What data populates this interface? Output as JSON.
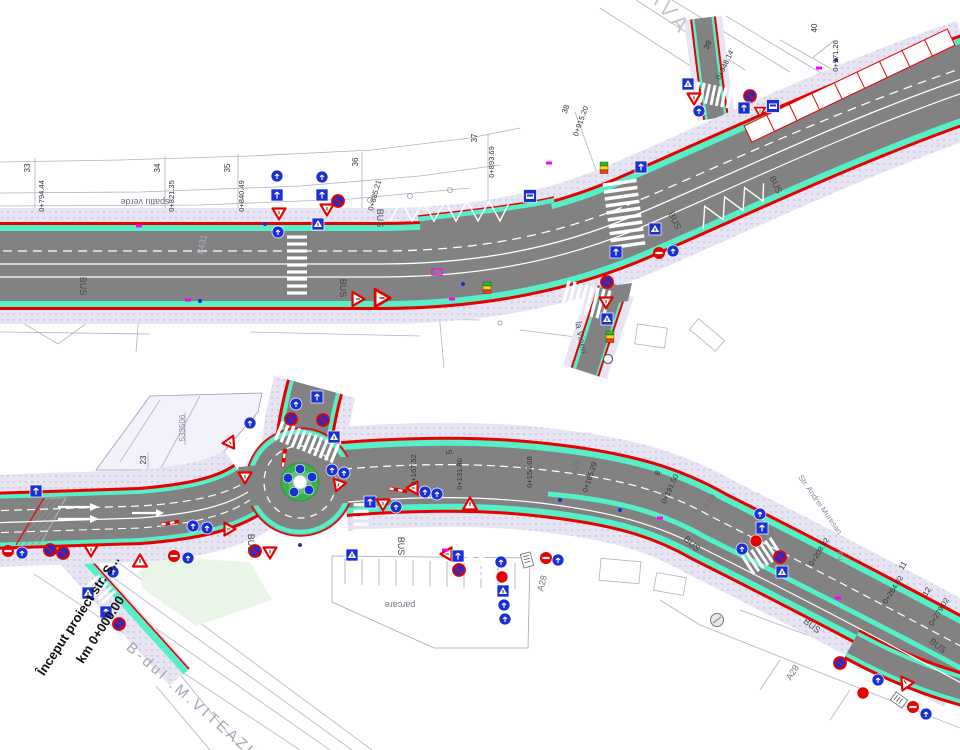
{
  "colors": {
    "asphalt": "#828282",
    "bike_lane_cyan": "#55f0c8",
    "sidewalk_lavender": "#e7e4f3",
    "edge_red": "#e60000",
    "sign_blue": "#1a2fd4",
    "sign_red": "#e60000",
    "marking_white": "#ffffff",
    "magenta_marker": "#ff00ff",
    "signal_green": "#22c31e",
    "signal_yellow": "#ffd800",
    "signal_red": "#ff3c00",
    "island_green": "#38b24d",
    "cadastral_grey": "#b4b0c6"
  },
  "top_plan": {
    "labels": [
      {
        "t": "33",
        "x": 30,
        "y": 168,
        "r": -90,
        "s": 8
      },
      {
        "t": "0+794.44",
        "x": 44,
        "y": 196,
        "r": -90,
        "s": 7.5
      },
      {
        "t": "34",
        "x": 160,
        "y": 168,
        "r": -90,
        "s": 8
      },
      {
        "t": "0+821.35",
        "x": 174,
        "y": 196,
        "r": -90,
        "s": 7.5
      },
      {
        "t": "35",
        "x": 230,
        "y": 168,
        "r": -90,
        "s": 8
      },
      {
        "t": "0+840.49",
        "x": 244,
        "y": 196,
        "r": -90,
        "s": 7.5
      },
      {
        "t": "36",
        "x": 358,
        "y": 162,
        "r": -90,
        "s": 8
      },
      {
        "t": "0+885.21",
        "x": 377,
        "y": 196,
        "r": -75,
        "s": 7.5
      },
      {
        "t": "37",
        "x": 477,
        "y": 138,
        "r": -90,
        "s": 8
      },
      {
        "t": "0+893.69",
        "x": 494,
        "y": 162,
        "r": -90,
        "s": 7.5
      },
      {
        "t": "38",
        "x": 568,
        "y": 110,
        "r": -70,
        "s": 8
      },
      {
        "t": "0+915.20",
        "x": 583,
        "y": 122,
        "r": -70,
        "s": 7.5
      },
      {
        "t": "39",
        "x": 710,
        "y": 46,
        "r": -65,
        "s": 8
      },
      {
        "t": "0+948.14",
        "x": 727,
        "y": 66,
        "r": -65,
        "s": 7.5
      },
      {
        "t": "40",
        "x": 817,
        "y": 28,
        "r": -90,
        "s": 8
      },
      {
        "t": "0+971.26",
        "x": 838,
        "y": 56,
        "r": -90,
        "s": 7.5
      },
      {
        "t": "spatiu verde",
        "x": 145,
        "y": 199,
        "r": 180,
        "s": 9,
        "c": "#6f6c80"
      },
      {
        "t": "AVA",
        "x": 664,
        "y": 16,
        "r": 50,
        "s": 22,
        "c": "#c6c6cc",
        "serif": true,
        "ls": 5
      },
      {
        "t": "8431",
        "x": 205,
        "y": 245,
        "r": -78,
        "s": 9,
        "c": "#b3adc6"
      },
      {
        "t": "la Vineri",
        "x": 578,
        "y": 338,
        "r": 80,
        "s": 9,
        "c": "#55525f"
      },
      {
        "t": "BUS",
        "x": 80,
        "y": 286,
        "r": 90,
        "s": 9,
        "c": "#464646"
      },
      {
        "t": "BUS",
        "x": 340,
        "y": 288,
        "r": 90,
        "s": 9,
        "c": "#464646"
      },
      {
        "t": "BUS",
        "x": 377,
        "y": 218,
        "r": 90,
        "s": 9,
        "c": "#464646"
      },
      {
        "t": "BUS",
        "x": 672,
        "y": 222,
        "r": 64,
        "s": 9,
        "c": "#464646"
      },
      {
        "t": "BUS",
        "x": 773,
        "y": 186,
        "r": 64,
        "s": 9,
        "c": "#464646"
      }
    ],
    "signs": [
      {
        "t": "blue",
        "x": 277,
        "y": 176
      },
      {
        "t": "sq",
        "x": 277,
        "y": 195
      },
      {
        "t": "yield",
        "x": 279,
        "y": 214
      },
      {
        "t": "blue",
        "x": 278,
        "y": 232
      },
      {
        "t": "blue",
        "x": 322,
        "y": 177
      },
      {
        "t": "sq",
        "x": 322,
        "y": 195
      },
      {
        "t": "yield",
        "x": 327,
        "y": 210
      },
      {
        "t": "sqA",
        "x": 318,
        "y": 224
      },
      {
        "t": "nostop",
        "x": 338,
        "y": 201
      },
      {
        "t": "warn",
        "x": 358,
        "y": 299,
        "r": 90
      },
      {
        "t": "warn",
        "x": 382,
        "y": 298,
        "r": 90,
        "sc": 1.25
      },
      {
        "t": "bus",
        "x": 530,
        "y": 196
      },
      {
        "t": "sq",
        "x": 641,
        "y": 167
      },
      {
        "t": "signal",
        "x": 604,
        "y": 168
      },
      {
        "t": "sqA",
        "x": 655,
        "y": 229
      },
      {
        "t": "sq",
        "x": 616,
        "y": 252
      },
      {
        "t": "noentry",
        "x": 659,
        "y": 253
      },
      {
        "t": "blue",
        "x": 673,
        "y": 251
      },
      {
        "t": "nostop",
        "x": 607,
        "y": 282
      },
      {
        "t": "yield",
        "x": 606,
        "y": 303
      },
      {
        "t": "sqA",
        "x": 607,
        "y": 319
      },
      {
        "t": "signal",
        "x": 610,
        "y": 337
      },
      {
        "t": "pole",
        "x": 608,
        "y": 359
      },
      {
        "t": "sqA",
        "x": 688,
        "y": 84
      },
      {
        "t": "yield",
        "x": 694,
        "y": 99
      },
      {
        "t": "blue",
        "x": 699,
        "y": 111
      },
      {
        "t": "nostop",
        "x": 750,
        "y": 96
      },
      {
        "t": "sq",
        "x": 744,
        "y": 108
      },
      {
        "t": "yield",
        "x": 760,
        "y": 112,
        "sc": 0.8
      },
      {
        "t": "bus",
        "x": 773,
        "y": 106
      },
      {
        "t": "signal",
        "x": 487,
        "y": 288
      },
      {
        "t": "dot",
        "x": 265,
        "y": 224
      },
      {
        "t": "dot",
        "x": 200,
        "y": 301
      },
      {
        "t": "dot",
        "x": 463,
        "y": 284
      },
      {
        "t": "dot",
        "x": 836,
        "y": 60
      },
      {
        "t": "mag",
        "x": 139,
        "y": 226
      },
      {
        "t": "mag",
        "x": 188,
        "y": 300
      },
      {
        "t": "mag",
        "x": 549,
        "y": 163
      },
      {
        "t": "mag",
        "x": 819,
        "y": 68
      },
      {
        "t": "magr",
        "x": 437,
        "y": 272
      },
      {
        "t": "mag",
        "x": 452,
        "y": 299
      }
    ]
  },
  "bottom_plan": {
    "labels": [
      {
        "t": "Început proiect str. S...",
        "x": 82,
        "y": 618,
        "r": -57,
        "s": 13,
        "c": "#111111",
        "b": true,
        "serif": true
      },
      {
        "t": "km 0+000.00",
        "x": 104,
        "y": 632,
        "r": -57,
        "s": 13,
        "c": "#111111",
        "b": true,
        "serif": true
      },
      {
        "t": "B-dul .M.VITEAZU",
        "x": 190,
        "y": 705,
        "r": 41,
        "s": 15,
        "c": "#a8a5b5",
        "serif": true,
        "ls": 3
      },
      {
        "t": "parcare",
        "x": 400,
        "y": 602,
        "r": 180,
        "s": 9,
        "c": "#777487"
      },
      {
        "t": "533506",
        "x": 185,
        "y": 428,
        "r": -90,
        "s": 8,
        "c": "#8b88a0"
      },
      {
        "t": "23",
        "x": 146,
        "y": 460,
        "r": -90,
        "s": 8
      },
      {
        "t": "5",
        "x": 452,
        "y": 452,
        "r": -90,
        "s": 8
      },
      {
        "t": "0+131.80",
        "x": 462,
        "y": 474,
        "r": -90,
        "s": 7.5
      },
      {
        "t": "0+154.08",
        "x": 532,
        "y": 472,
        "r": -90,
        "s": 7.5
      },
      {
        "t": "A26",
        "x": 578,
        "y": 468,
        "r": -72,
        "s": 9,
        "c": "#77747f"
      },
      {
        "t": "0+165.29",
        "x": 592,
        "y": 478,
        "r": -72,
        "s": 7.5
      },
      {
        "t": "8",
        "x": 660,
        "y": 474,
        "r": -65,
        "s": 8
      },
      {
        "t": "0+191.50",
        "x": 672,
        "y": 490,
        "r": -65,
        "s": 7.5
      },
      {
        "t": "A29",
        "x": 712,
        "y": 503,
        "r": -58,
        "s": 9,
        "c": "#77747f"
      },
      {
        "t": "Str. Andrei Muresan",
        "x": 818,
        "y": 506,
        "r": 55,
        "s": 8,
        "c": "#8b88a0"
      },
      {
        "t": "0+167.52",
        "x": 416,
        "y": 470,
        "r": -90,
        "s": 7.5
      },
      {
        "t": "0+208.82",
        "x": 821,
        "y": 553,
        "r": -58,
        "s": 7.5
      },
      {
        "t": "2",
        "x": 840,
        "y": 560,
        "r": 0,
        "s": 12,
        "c": "#99969f"
      },
      {
        "t": "11",
        "x": 905,
        "y": 567,
        "r": -58,
        "s": 8
      },
      {
        "t": "0+264.02",
        "x": 895,
        "y": 591,
        "r": -58,
        "s": 7.5
      },
      {
        "t": "12",
        "x": 929,
        "y": 593,
        "r": -58,
        "s": 8
      },
      {
        "t": "0+279.02",
        "x": 941,
        "y": 613,
        "r": -58,
        "s": 7.5
      },
      {
        "t": "A28",
        "x": 545,
        "y": 584,
        "r": -75,
        "s": 9,
        "c": "#77747f"
      },
      {
        "t": "A28",
        "x": 795,
        "y": 674,
        "r": -58,
        "s": 9,
        "c": "#77747f"
      },
      {
        "t": "BUS",
        "x": 248,
        "y": 543,
        "r": 90,
        "s": 9,
        "c": "#464646"
      },
      {
        "t": "BUS",
        "x": 398,
        "y": 546,
        "r": 90,
        "s": 9,
        "c": "#464646"
      },
      {
        "t": "BUS",
        "x": 690,
        "y": 546,
        "r": 42,
        "s": 9,
        "c": "#464646"
      },
      {
        "t": "BUS",
        "x": 810,
        "y": 628,
        "r": 38,
        "s": 9,
        "c": "#464646"
      },
      {
        "t": "BUS",
        "x": 936,
        "y": 648,
        "r": 38,
        "s": 9,
        "c": "#464646"
      }
    ],
    "signs": [
      {
        "t": "noentry",
        "x": 8,
        "y": 551
      },
      {
        "t": "blue",
        "x": 22,
        "y": 553
      },
      {
        "t": "nostop",
        "x": 50,
        "y": 550
      },
      {
        "t": "nostop",
        "x": 63,
        "y": 553
      },
      {
        "t": "sq",
        "x": 36,
        "y": 491
      },
      {
        "t": "yield",
        "x": 91,
        "y": 551
      },
      {
        "t": "warn",
        "x": 140,
        "y": 561
      },
      {
        "t": "sqA",
        "x": 88,
        "y": 593
      },
      {
        "t": "blue",
        "x": 113,
        "y": 572
      },
      {
        "t": "sq",
        "x": 106,
        "y": 612
      },
      {
        "t": "nostop",
        "x": 119,
        "y": 624
      },
      {
        "t": "noentry",
        "x": 174,
        "y": 556
      },
      {
        "t": "blue",
        "x": 188,
        "y": 558
      },
      {
        "t": "candy",
        "x": 170,
        "y": 523,
        "r": 80
      },
      {
        "t": "blue",
        "x": 193,
        "y": 526
      },
      {
        "t": "blue",
        "x": 207,
        "y": 528
      },
      {
        "t": "yield",
        "x": 230,
        "y": 529,
        "r": -90
      },
      {
        "t": "nostop",
        "x": 255,
        "y": 551
      },
      {
        "t": "yield",
        "x": 270,
        "y": 553
      },
      {
        "t": "sq",
        "x": 317,
        "y": 397
      },
      {
        "t": "blue",
        "x": 296,
        "y": 404
      },
      {
        "t": "nostop",
        "x": 291,
        "y": 419
      },
      {
        "t": "nostop",
        "x": 323,
        "y": 420
      },
      {
        "t": "sqA",
        "x": 334,
        "y": 437
      },
      {
        "t": "blue",
        "x": 250,
        "y": 423
      },
      {
        "t": "yield",
        "x": 231,
        "y": 444,
        "r": -35
      },
      {
        "t": "candy",
        "x": 284,
        "y": 458,
        "r": 8
      },
      {
        "t": "yield",
        "x": 245,
        "y": 478
      },
      {
        "t": "blue",
        "x": 332,
        "y": 470
      },
      {
        "t": "blue",
        "x": 344,
        "y": 473
      },
      {
        "t": "yield",
        "x": 338,
        "y": 486,
        "r": 20
      },
      {
        "t": "candy",
        "x": 398,
        "y": 490,
        "r": 100
      },
      {
        "t": "yield",
        "x": 412,
        "y": 488,
        "r": 90
      },
      {
        "t": "blue",
        "x": 425,
        "y": 492
      },
      {
        "t": "blue",
        "x": 437,
        "y": 494
      },
      {
        "t": "sq",
        "x": 370,
        "y": 502
      },
      {
        "t": "yield",
        "x": 383,
        "y": 505
      },
      {
        "t": "blue",
        "x": 396,
        "y": 507
      },
      {
        "t": "warn",
        "x": 470,
        "y": 504
      },
      {
        "t": "sqA",
        "x": 352,
        "y": 555
      },
      {
        "t": "yield",
        "x": 446,
        "y": 554,
        "r": 90
      },
      {
        "t": "sq",
        "x": 458,
        "y": 556
      },
      {
        "t": "nostop",
        "x": 459,
        "y": 570
      },
      {
        "t": "blue",
        "x": 501,
        "y": 562
      },
      {
        "t": "stop",
        "x": 502,
        "y": 577
      },
      {
        "t": "sqA",
        "x": 503,
        "y": 591
      },
      {
        "t": "blue",
        "x": 504,
        "y": 605
      },
      {
        "t": "blue",
        "x": 505,
        "y": 619
      },
      {
        "t": "panel",
        "x": 527,
        "y": 560,
        "r": -15
      },
      {
        "t": "noentry",
        "x": 546,
        "y": 558
      },
      {
        "t": "blue",
        "x": 558,
        "y": 560
      },
      {
        "t": "blue",
        "x": 760,
        "y": 514
      },
      {
        "t": "sq",
        "x": 762,
        "y": 528
      },
      {
        "t": "stop",
        "x": 756,
        "y": 541
      },
      {
        "t": "blue",
        "x": 742,
        "y": 549
      },
      {
        "t": "nostop",
        "x": 780,
        "y": 557
      },
      {
        "t": "sqA",
        "x": 782,
        "y": 572
      },
      {
        "t": "greycirc",
        "x": 717,
        "y": 620
      },
      {
        "t": "nostop",
        "x": 840,
        "y": 663
      },
      {
        "t": "blue",
        "x": 878,
        "y": 680
      },
      {
        "t": "stop",
        "x": 863,
        "y": 693
      },
      {
        "t": "warn",
        "x": 905,
        "y": 682,
        "r": -35
      },
      {
        "t": "panel",
        "x": 899,
        "y": 700,
        "r": -55
      },
      {
        "t": "noentry",
        "x": 913,
        "y": 707
      },
      {
        "t": "blue",
        "x": 926,
        "y": 714
      },
      {
        "t": "mag",
        "x": 445,
        "y": 550
      },
      {
        "t": "mag",
        "x": 660,
        "y": 518
      },
      {
        "t": "mag",
        "x": 838,
        "y": 598
      },
      {
        "t": "dot",
        "x": 560,
        "y": 500
      },
      {
        "t": "dot",
        "x": 300,
        "y": 545
      },
      {
        "t": "dot",
        "x": 620,
        "y": 510
      }
    ]
  }
}
